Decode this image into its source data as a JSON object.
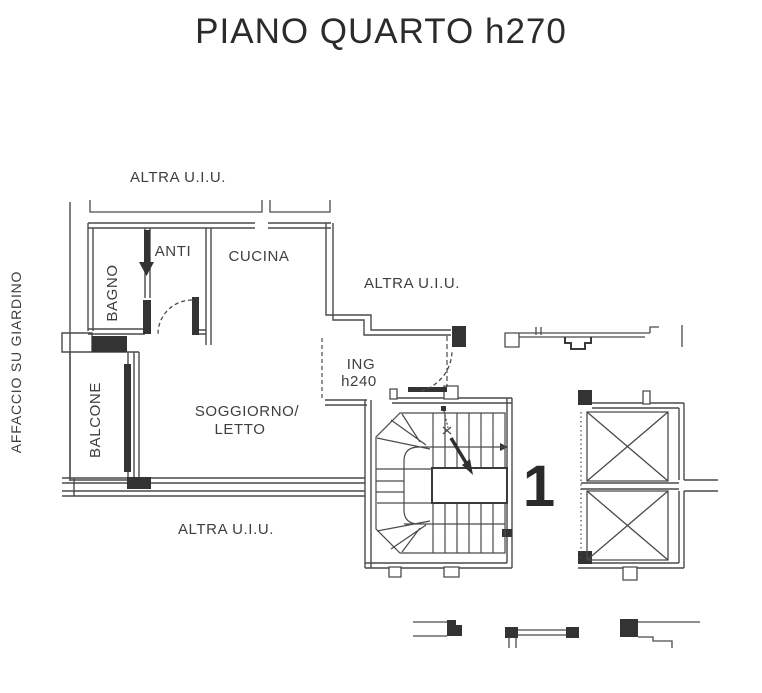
{
  "title": "PIANO QUARTO h270",
  "labels": {
    "affaccio_su_giardino": "AFFACCIO SU GIARDINO",
    "altra_uiu_top": "ALTRA U.I.U.",
    "altra_uiu_right": "ALTRA U.I.U.",
    "altra_uiu_bottom": "ALTRA U.I.U.",
    "bagno": "BAGNO",
    "anti": "ANTI",
    "cucina": "CUCINA",
    "balcone": "BALCONE",
    "soggiorno_line1": "SOGGIORNO/",
    "soggiorno_line2": "LETTO",
    "ing_line1": "ING",
    "ing_line2": "h240",
    "unit_number": "1"
  },
  "colors": {
    "ink_thin": "#4a4a4a",
    "ink_thick": "#333333",
    "text": "#3e3e3e",
    "background": "#ffffff"
  }
}
